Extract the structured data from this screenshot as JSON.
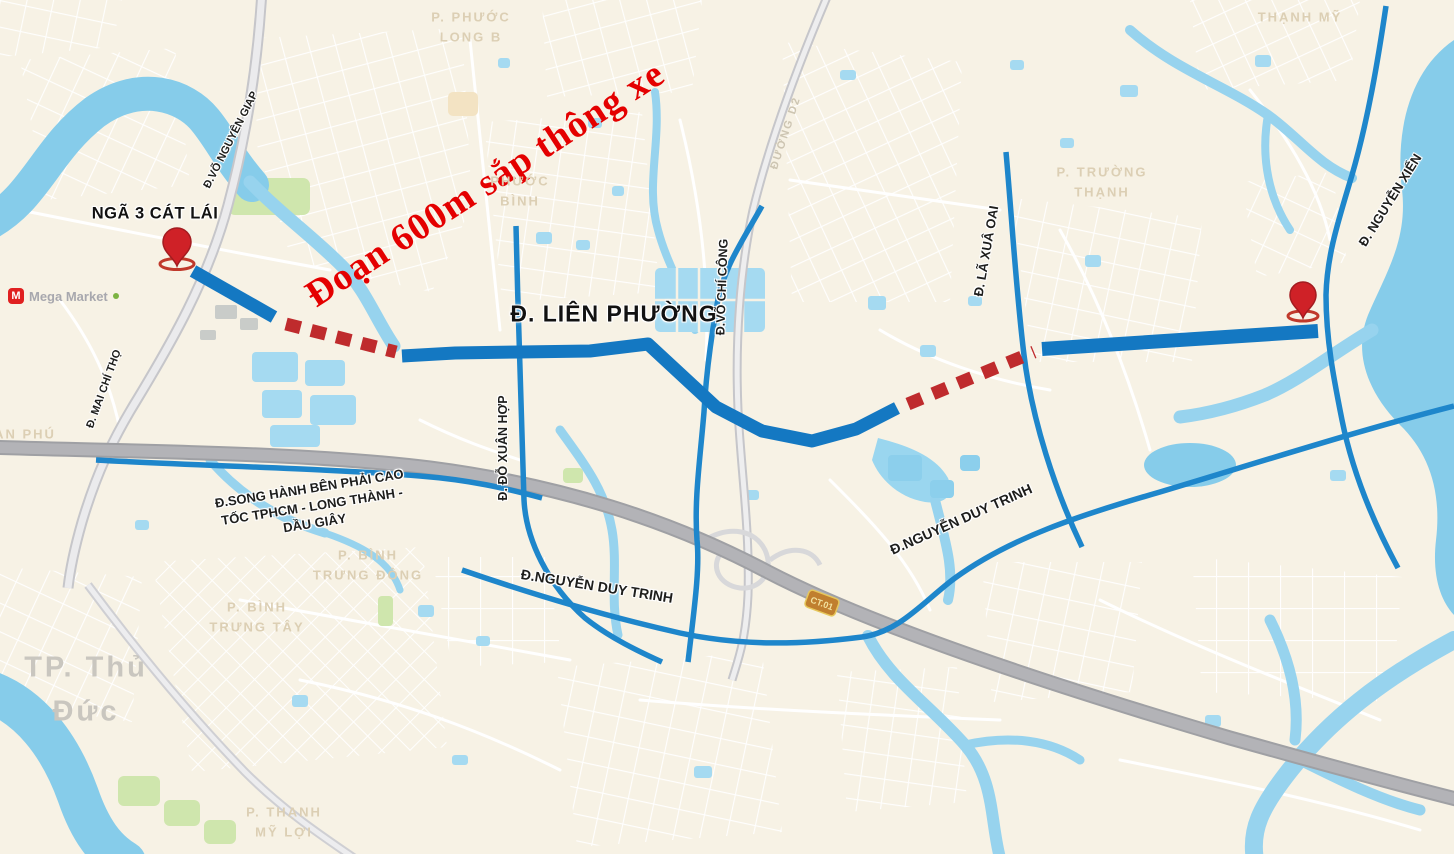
{
  "annotations": {
    "headline": "Đoạn 600m sắp thông xe",
    "junction": "NGÃ 3 CÁT LÁI",
    "featured_road": "Đ. LIÊN PHƯỜNG"
  },
  "roads": {
    "vo_nguyen_giap": "Đ.VÕ NGUYÊN GIAP",
    "mai_chi_tho": "Đ. MAI CHÍ THỌ",
    "do_xuan_hop": "Đ. ĐỖ XUÂN HỢP",
    "vo_chi_cong": "Đ.VÕ CHÍ CÔNG",
    "la_xuan_oai": "Đ. LÃ XUÂ OAI",
    "nguyen_xien": "Đ. NGUYỄN XIỂN",
    "nguyen_duy_trinh_west": "Đ.NGUYỄN DUY TRINH",
    "nguyen_duy_trinh_east": "Đ.NGUYỄN DUY TRINH",
    "duong_d2": "ĐƯỜNG D2",
    "song_hanh": {
      "lines": [
        "Đ.SONG HÀNH BÊN PHẢI CAO",
        "TỐC TPHCM - LONG THÀNH -",
        "DẦU GIÂY"
      ]
    }
  },
  "areas": {
    "phuoc_long_b": {
      "lines": [
        "P. PHƯỚC",
        "LONG B"
      ]
    },
    "phuoc_binh": {
      "lines": [
        "PHƯỚC",
        "BÌNH"
      ]
    },
    "thanh_my": {
      "lines": [
        "THẠNH MỸ"
      ]
    },
    "truong_thanh": {
      "lines": [
        "P. TRƯỜNG",
        "THẠNH"
      ]
    },
    "binh_trung_dong": {
      "lines": [
        "P. BÌNH",
        "TRƯNG ĐÔNG"
      ]
    },
    "binh_trung_tay": {
      "lines": [
        "P. BÌNH",
        "TRƯNG TÂY"
      ]
    },
    "thanh_my_loi": {
      "lines": [
        "P. THẠNH",
        "MỸ LỢI"
      ]
    },
    "an_phu": {
      "lines": [
        "AN PHÚ"
      ]
    },
    "tp_thu_duc": {
      "lines": [
        "TP. Thủ",
        "Đức"
      ]
    }
  },
  "poi": {
    "mega_market": "Mega Market",
    "mega_market_initial": "M",
    "highway_shield": "CT.01"
  },
  "colors": {
    "land": "#f7f2e5",
    "river": "#86ccea",
    "pond": "#a5daf1",
    "overlay_road_blue": "#1478c2",
    "construction_dash_red": "#bf2b2d",
    "pin_red": "#cf2127",
    "headline_red": "#e40000"
  }
}
